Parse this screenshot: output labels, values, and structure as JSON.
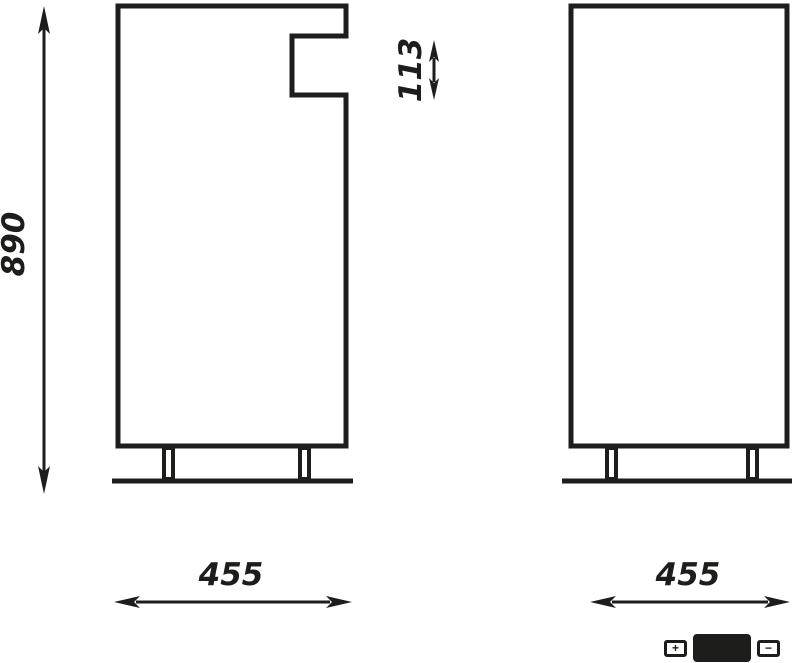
{
  "page": {
    "background": "#ffffff"
  },
  "drawing": {
    "stroke_color": "#1d1d1b",
    "left_figure": {
      "name": "side-panel-with-notch",
      "height_dim": "890",
      "notch_dim": "113",
      "width_dim": "455"
    },
    "right_figure": {
      "name": "side-panel-plain",
      "width_dim": "455"
    }
  },
  "zoom_widget": {
    "zoom_in": "+",
    "zoom_out": "−"
  }
}
